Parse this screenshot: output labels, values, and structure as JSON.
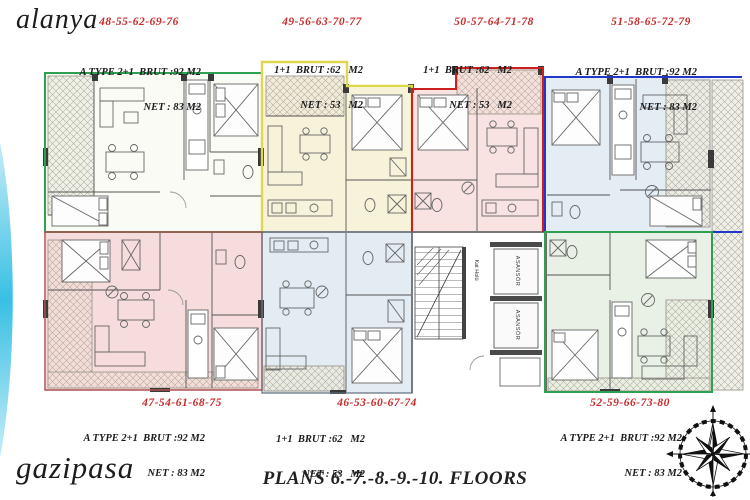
{
  "branding": {
    "top_left": "alanya",
    "bottom_left": "gazipasa"
  },
  "footer": {
    "title": "PLANS 6.-7.-8.-9.-10. FLOORS"
  },
  "units": {
    "top": [
      {
        "code": "48-55-62-69-76",
        "line1": "A TYPE 2+1  BRUT :92 M2",
        "line2": "NET : 83 M2",
        "outline_color": "#2fa052",
        "fill_color": "#fbfbf6"
      },
      {
        "code": "49-56-63-70-77",
        "line1": "1+1  BRUT :62   M2",
        "line2": "NET : 53   M2",
        "outline_color": "#ddd84e",
        "fill_color": "#f6f3da"
      },
      {
        "code": "50-57-64-71-78",
        "line1": "1+1  BRUT :62   M2",
        "line2": "NET : 53   M2",
        "outline_color": "#cc2020",
        "fill_color": "#f8e2e2"
      },
      {
        "code": "51-58-65-72-79",
        "line1": "A TYPE 2+1  BRUT :92 M2",
        "line2": "NET : 83 M2",
        "outline_color": "#2236c8",
        "fill_color": "#e4ecf4"
      }
    ],
    "bottom": [
      {
        "code": "47-54-61-68-75",
        "line1": "A TYPE 2+1  BRUT :92 M2",
        "line2": "NET : 83 M2",
        "outline_color": "#b05050",
        "fill_color": "#f6dcdc"
      },
      {
        "code": "46-53-60-67-74",
        "line1": "1+1  BRUT :62   M2",
        "line2": "NET : 53   M2",
        "outline_color": "#5f6d7a",
        "fill_color": "#e2ecf2"
      },
      {
        "code": "52-59-66-73-80",
        "line1": "A TYPE 2+1  BRUT :92 M2",
        "line2": "NET : 83 M2",
        "outline_color": "#2fa052",
        "fill_color": "#e9f0e5"
      }
    ]
  },
  "core": {
    "elevator_label": "ASANSÖR",
    "hall_label": "Kat Holü"
  },
  "colors": {
    "label_red": "#c92a2a",
    "wall": "#4a4a4a",
    "hatch_line": "#b3ab9c",
    "swoosh_cyan": "#38c0e4"
  }
}
